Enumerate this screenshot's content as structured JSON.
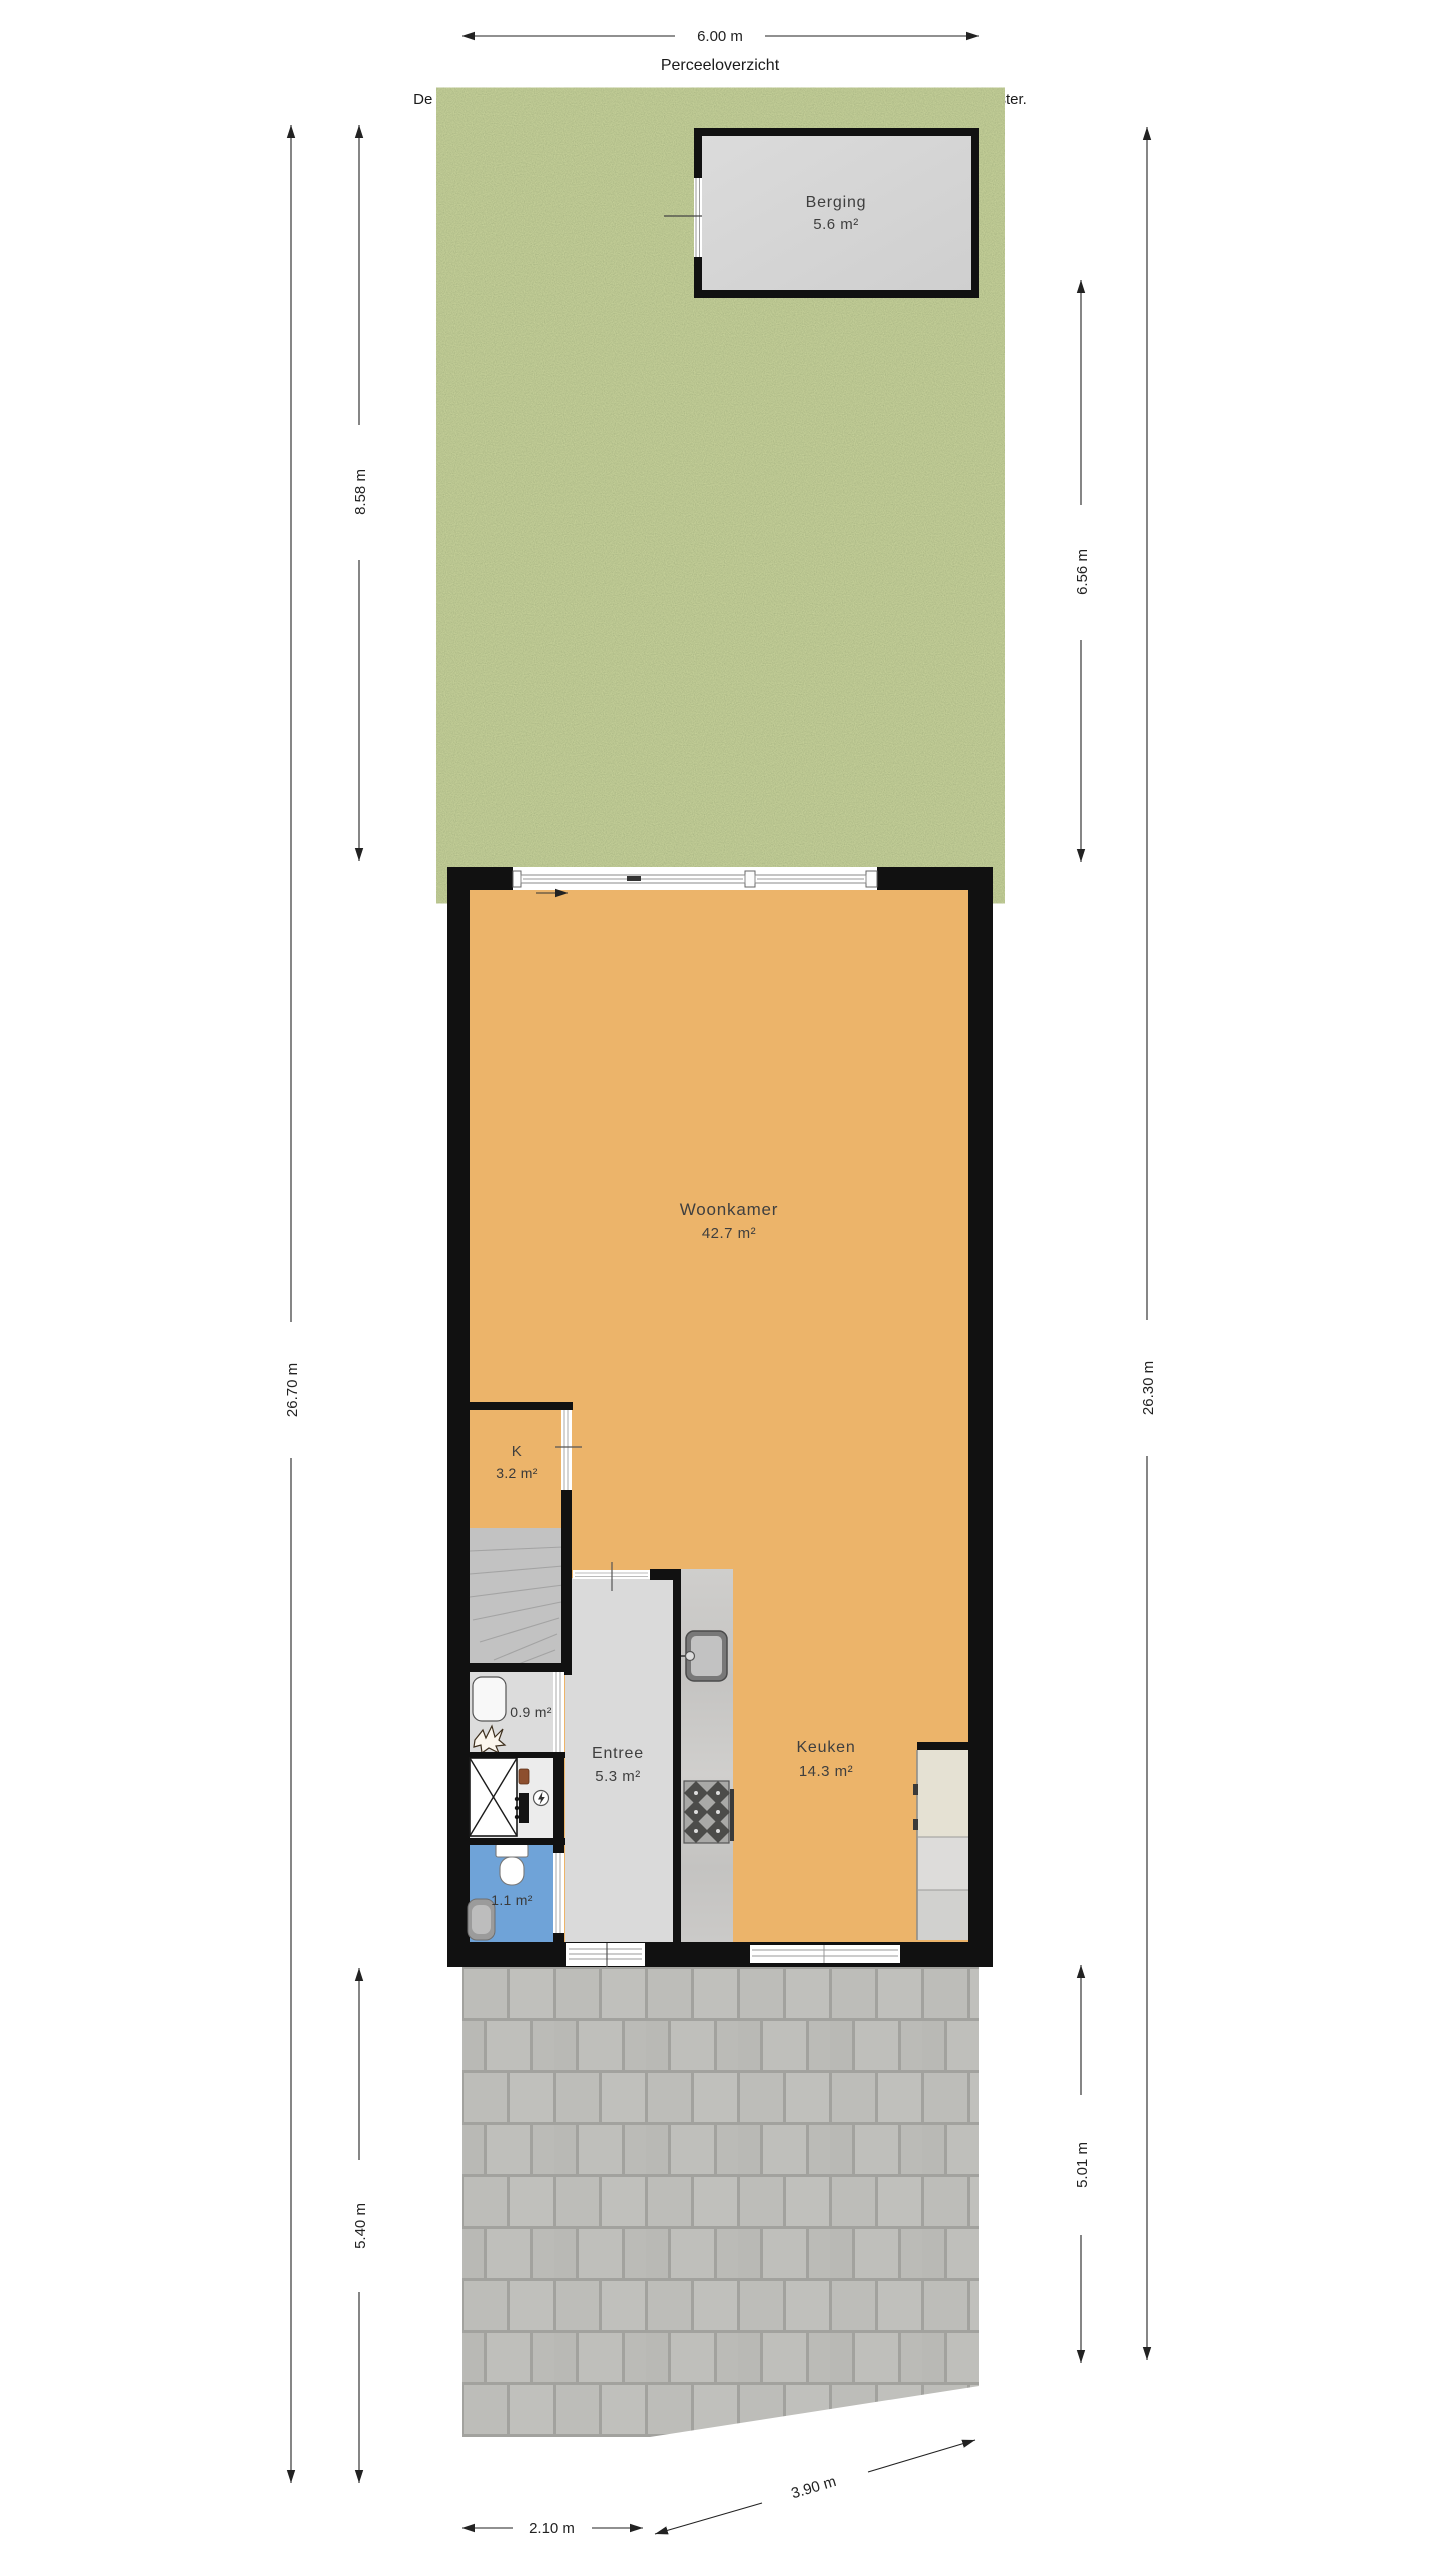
{
  "header": {
    "title": "Perceeloverzicht",
    "disclaimer": "De afmetingen van het perceel zijn indicatief. Raadpleeg voor de exacte maten het kadaster."
  },
  "dimensions": {
    "plot_width_top": "6.00 m",
    "left_total_depth": "26.70 m",
    "garden_depth_left": "8.58 m",
    "garden_depth_right": "6.56 m",
    "right_total_depth": "26.30 m",
    "terrace_depth_left": "5.40 m",
    "terrace_depth_right": "5.01 m",
    "terrace_width_left": "2.10 m",
    "terrace_width_right": "3.90 m"
  },
  "rooms": {
    "berging": {
      "label": "Berging",
      "area": "5.6 m²"
    },
    "woonkamer": {
      "label": "Woonkamer",
      "area": "42.7 m²"
    },
    "kast": {
      "label": "K",
      "area": "3.2 m²"
    },
    "entree": {
      "label": "Entree",
      "area": "5.3 m²"
    },
    "keuken": {
      "label": "Keuken",
      "area": "14.3 m²"
    },
    "kast_klein": {
      "area": "0.9 m²"
    },
    "toilet": {
      "area": "1.1 m²"
    }
  },
  "colors": {
    "wall": "#111111",
    "floor_living": "#ecb46a",
    "floor_hall": "#dadada",
    "floor_stairs": "#c2c2c2",
    "floor_toilet": "#6fa3d8",
    "floor_storage": "#dcdcdc",
    "floor_meter": "#ececec",
    "shed_floor": "#d6d6d6",
    "grass": "#7d8c4f",
    "paving": "#bcbcb8",
    "dimension_lines": "#222222",
    "label_text": "#3f3f3f"
  }
}
